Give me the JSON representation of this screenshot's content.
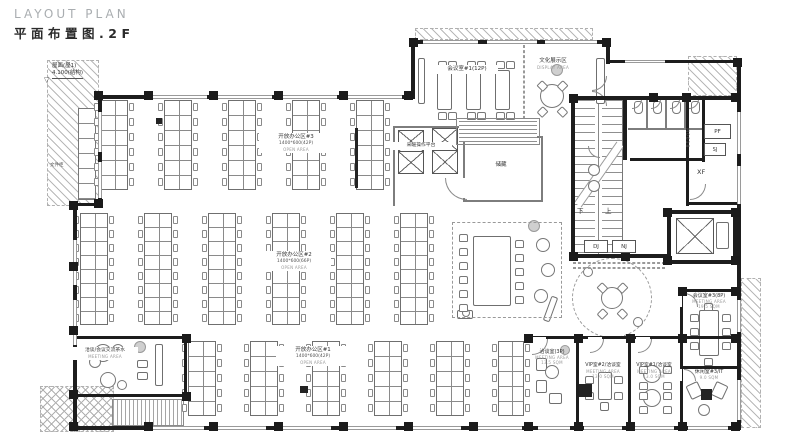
{
  "title": {
    "en": "LAYOUT PLAN",
    "zh": "平面布置图.2F"
  },
  "colors": {
    "wall": "#1d1d1d",
    "line": "#6f6f6f",
    "hatch": "#b8b8b8",
    "title_gray": "#a9adb0",
    "text": "#333333"
  },
  "annotations": {
    "roof_line1": "屋面(屋1)",
    "roof_line2": "4.100(结构)",
    "level_symbol": "▽",
    "cabinet": "文件柜",
    "platform": "采暖操作平台",
    "storage": "储藏",
    "stair_up": "上",
    "stair_down": "下",
    "dj": "DJ",
    "nj": "NJ",
    "pf": "PF",
    "sj": "SJ",
    "xf": "XF",
    "door_tag": "M0618"
  },
  "rooms": {
    "open3": {
      "name": "开放办公区#3",
      "spec": "1400*600(42P)",
      "en": "OPEN AREA"
    },
    "open2": {
      "name": "开放办公区#2",
      "spec": "1400*600(66P)",
      "en": "OPEN AREA"
    },
    "open1": {
      "name": "开放办公区#1",
      "spec": "1400*600(42P)",
      "en": "OPEN AREA"
    },
    "meeting1": {
      "name": "会议室#1(12P)"
    },
    "culture": {
      "name": "文化展示区",
      "en": "DISPLAY AREA"
    },
    "meeting3": {
      "name": "会议室#3(8P)",
      "en": "MEETING AREA",
      "area": "19.5 SQM"
    },
    "lounge3": {
      "name": "休闲室#3/IT",
      "area": "9.0 SQM"
    },
    "talk": {
      "name": "洽谈室(3P)",
      "en": "MEETING AREA",
      "area": "13.5 SQM"
    },
    "vip2": {
      "name": "VIP室#2/洽谈室",
      "en": "MEETING AREA",
      "area": "13.0 SQM"
    },
    "vip1": {
      "name": "VIP室#1/洽谈室",
      "en": "MEETING AREA",
      "area": "13.0 SQM"
    },
    "tea": {
      "name": "洽谈/会议交流茶水",
      "en": "MEETING AREA"
    }
  },
  "plan": {
    "hatches": [
      [
        47,
        60,
        52,
        146,
        "d"
      ],
      [
        40,
        386,
        74,
        46,
        "c"
      ],
      [
        688,
        56,
        49,
        40,
        "d"
      ],
      [
        741,
        278,
        20,
        150,
        "d"
      ],
      [
        415,
        28,
        178,
        12,
        "d"
      ]
    ],
    "deck": [
      112,
      399,
      72,
      27
    ],
    "cabinet_runs": [
      [
        78,
        108,
        18,
        92,
        15
      ]
    ],
    "desk_strips": [
      [
        100,
        100,
        6,
        15,
        28
      ],
      [
        164,
        100,
        6,
        15,
        28
      ],
      [
        228,
        100,
        6,
        15,
        28
      ],
      [
        292,
        100,
        6,
        15,
        28
      ],
      [
        356,
        100,
        6,
        15,
        28
      ],
      [
        80,
        213,
        8,
        14,
        28
      ],
      [
        144,
        213,
        8,
        14,
        28
      ],
      [
        208,
        213,
        8,
        14,
        28
      ],
      [
        272,
        213,
        8,
        14,
        28
      ],
      [
        336,
        213,
        8,
        14,
        28
      ],
      [
        400,
        213,
        8,
        14,
        28
      ],
      [
        188,
        341,
        5,
        15,
        28
      ],
      [
        250,
        341,
        5,
        15,
        28
      ],
      [
        312,
        341,
        5,
        15,
        28
      ],
      [
        374,
        341,
        5,
        15,
        28
      ],
      [
        436,
        341,
        5,
        15,
        28
      ],
      [
        498,
        341,
        5,
        15,
        26
      ]
    ],
    "tables": [
      [
        437,
        70,
        15,
        40
      ],
      [
        466,
        70,
        15,
        40
      ],
      [
        495,
        70,
        15,
        40
      ],
      [
        473,
        236,
        38,
        70
      ],
      [
        699,
        310,
        20,
        46
      ],
      [
        598,
        372,
        14,
        28
      ],
      [
        418,
        58,
        7,
        46
      ],
      [
        596,
        58,
        9,
        46
      ],
      [
        457,
        310,
        16,
        9
      ],
      [
        155,
        344,
        8,
        42
      ],
      [
        137,
        360,
        11,
        8
      ],
      [
        137,
        372,
        11,
        8
      ],
      [
        536,
        358,
        11,
        13
      ],
      [
        536,
        380,
        11,
        13
      ],
      [
        549,
        393,
        13,
        11
      ],
      [
        688,
        383,
        13,
        15,
        -25
      ],
      [
        713,
        383,
        13,
        15,
        25
      ],
      [
        600,
        402,
        9,
        9
      ],
      [
        716,
        222,
        13,
        27
      ],
      [
        547,
        296,
        7,
        26,
        20
      ]
    ],
    "toilets": [
      [
        634,
        101,
        9,
        13
      ],
      [
        653,
        101,
        9,
        13
      ],
      [
        672,
        101,
        9,
        13
      ],
      [
        691,
        101,
        9,
        13
      ]
    ],
    "filled": [
      [
        578,
        384,
        14,
        13
      ],
      [
        701,
        389,
        11,
        11
      ],
      [
        156,
        118,
        6,
        6
      ],
      [
        298,
        252,
        8,
        7
      ],
      [
        300,
        386,
        8,
        7
      ],
      [
        355,
        128,
        3,
        60
      ]
    ],
    "circles": [
      [
        612,
        298,
        40,
        "dash"
      ],
      [
        612,
        298,
        11,
        "s"
      ],
      [
        588,
        272,
        5,
        "s"
      ],
      [
        638,
        322,
        5,
        "s"
      ],
      [
        552,
        96,
        12,
        "s"
      ],
      [
        557,
        70,
        6,
        "g"
      ],
      [
        543,
        245,
        7,
        "s"
      ],
      [
        548,
        270,
        7,
        "s"
      ],
      [
        541,
        296,
        7,
        "s"
      ],
      [
        534,
        226,
        6,
        "g"
      ],
      [
        652,
        374,
        9,
        "s"
      ],
      [
        652,
        398,
        9,
        "s"
      ],
      [
        552,
        372,
        7,
        "s"
      ],
      [
        565,
        350,
        5,
        "g"
      ],
      [
        103,
        353,
        9,
        "s"
      ],
      [
        95,
        362,
        6,
        "s"
      ],
      [
        118,
        350,
        6,
        "s"
      ],
      [
        140,
        347,
        6,
        "g"
      ],
      [
        108,
        380,
        8,
        "s"
      ],
      [
        122,
        385,
        5,
        "s"
      ],
      [
        594,
        170,
        6,
        "s"
      ],
      [
        594,
        186,
        6,
        "s"
      ],
      [
        704,
        410,
        6,
        "s"
      ],
      [
        466,
        313,
        4,
        "s"
      ]
    ],
    "chairs": [
      [
        438,
        61
      ],
      [
        448,
        61
      ],
      [
        467,
        61
      ],
      [
        477,
        61
      ],
      [
        496,
        61
      ],
      [
        506,
        61
      ],
      [
        438,
        112
      ],
      [
        448,
        112
      ],
      [
        467,
        112
      ],
      [
        477,
        112
      ],
      [
        496,
        112
      ],
      [
        506,
        112
      ],
      [
        690,
        314
      ],
      [
        690,
        328
      ],
      [
        690,
        342
      ],
      [
        722,
        314
      ],
      [
        722,
        328
      ],
      [
        722,
        342
      ],
      [
        704,
        303
      ],
      [
        704,
        358
      ],
      [
        459,
        234
      ],
      [
        459,
        248
      ],
      [
        459,
        262
      ],
      [
        459,
        276
      ],
      [
        459,
        290
      ],
      [
        459,
        304
      ],
      [
        515,
        240
      ],
      [
        515,
        254
      ],
      [
        515,
        268
      ],
      [
        515,
        282
      ],
      [
        515,
        296
      ],
      [
        639,
        366
      ],
      [
        663,
        366
      ],
      [
        639,
        382
      ],
      [
        663,
        382
      ],
      [
        639,
        392
      ],
      [
        663,
        392
      ],
      [
        639,
        406
      ],
      [
        663,
        406
      ],
      [
        585,
        376
      ],
      [
        614,
        376
      ],
      [
        585,
        392
      ],
      [
        614,
        392
      ],
      [
        598,
        284,
        45
      ],
      [
        618,
        284,
        -45
      ],
      [
        598,
        310,
        -45
      ],
      [
        618,
        310,
        45
      ],
      [
        538,
        82,
        45
      ],
      [
        558,
        82,
        -45
      ],
      [
        538,
        108,
        -45
      ],
      [
        558,
        108,
        45
      ]
    ],
    "doors": [
      [
        532,
        339,
        16,
        "br"
      ],
      [
        590,
        339,
        14,
        "br"
      ],
      [
        638,
        339,
        14,
        "br"
      ],
      [
        684,
        293,
        14,
        "tr"
      ],
      [
        684,
        369,
        12,
        "tr"
      ],
      [
        445,
        178,
        22,
        "bl"
      ],
      [
        592,
        76,
        15,
        "br"
      ],
      [
        592,
        91,
        15,
        "tr"
      ],
      [
        632,
        99,
        10,
        "br"
      ],
      [
        651,
        99,
        10,
        "br"
      ],
      [
        670,
        99,
        10,
        "br"
      ],
      [
        689,
        99,
        10,
        "br"
      ],
      [
        588,
        146,
        12,
        "bl"
      ],
      [
        690,
        184,
        16,
        "br"
      ]
    ],
    "xboxes": [
      [
        398,
        130,
        26,
        44,
        2
      ],
      [
        432,
        128,
        26,
        46,
        2
      ],
      [
        676,
        218,
        38,
        36,
        1
      ]
    ],
    "thin_walls": [
      [
        463,
        136,
        80,
        2
      ],
      [
        463,
        136,
        2,
        66
      ],
      [
        463,
        200,
        80,
        2
      ],
      [
        541,
        136,
        2,
        66
      ],
      [
        393,
        126,
        2,
        80
      ],
      [
        393,
        126,
        70,
        2
      ],
      [
        646,
        100,
        2,
        30
      ],
      [
        665,
        100,
        2,
        30
      ],
      [
        684,
        100,
        2,
        30
      ],
      [
        628,
        128,
        78,
        2
      ]
    ],
    "walls": [
      [
        413,
        40,
        197,
        4
      ],
      [
        411,
        40,
        4,
        58
      ],
      [
        606,
        40,
        4,
        24
      ],
      [
        606,
        60,
        134,
        3
      ],
      [
        737,
        60,
        4,
        370
      ],
      [
        98,
        95,
        317,
        4
      ],
      [
        98,
        95,
        4,
        111
      ],
      [
        73,
        203,
        29,
        3
      ],
      [
        73,
        203,
        4,
        227
      ],
      [
        73,
        426,
        668,
        4
      ],
      [
        73,
        336,
        113,
        3
      ],
      [
        184,
        336,
        3,
        62
      ],
      [
        73,
        394,
        113,
        3
      ],
      [
        528,
        336,
        212,
        3
      ],
      [
        576,
        336,
        3,
        92
      ],
      [
        628,
        336,
        3,
        92
      ],
      [
        680,
        289,
        3,
        139
      ],
      [
        680,
        289,
        60,
        3
      ],
      [
        680,
        366,
        58,
        3
      ],
      [
        571,
        96,
        169,
        4
      ],
      [
        571,
        96,
        4,
        162
      ],
      [
        623,
        96,
        4,
        64
      ],
      [
        571,
        254,
        96,
        4
      ],
      [
        702,
        96,
        3,
        66
      ],
      [
        686,
        96,
        3,
        110
      ],
      [
        630,
        158,
        74,
        3
      ],
      [
        686,
        202,
        51,
        3
      ],
      [
        667,
        210,
        72,
        4
      ],
      [
        667,
        210,
        4,
        54
      ],
      [
        667,
        260,
        72,
        4
      ],
      [
        733,
        210,
        4,
        54
      ]
    ],
    "windows": [
      [
        152,
        95,
        55,
        4
      ],
      [
        217,
        95,
        55,
        4
      ],
      [
        282,
        95,
        55,
        4
      ],
      [
        347,
        95,
        55,
        4
      ],
      [
        423,
        40,
        55,
        4
      ],
      [
        487,
        40,
        50,
        4
      ],
      [
        545,
        40,
        52,
        4
      ],
      [
        625,
        60,
        40,
        3
      ],
      [
        98,
        112,
        4,
        40
      ],
      [
        98,
        162,
        4,
        36
      ],
      [
        73,
        240,
        4,
        45
      ],
      [
        73,
        300,
        4,
        45
      ],
      [
        152,
        426,
        52,
        4
      ],
      [
        214,
        426,
        52,
        4
      ],
      [
        279,
        426,
        52,
        4
      ],
      [
        344,
        426,
        52,
        4
      ],
      [
        409,
        426,
        52,
        4
      ],
      [
        474,
        426,
        48,
        4
      ],
      [
        538,
        426,
        32,
        4
      ],
      [
        584,
        426,
        38,
        4
      ],
      [
        634,
        426,
        40,
        4
      ],
      [
        688,
        426,
        40,
        4
      ],
      [
        737,
        112,
        4,
        42
      ],
      [
        737,
        166,
        4,
        38
      ],
      [
        737,
        300,
        4,
        32
      ],
      [
        737,
        380,
        4,
        40
      ]
    ],
    "gaps": [
      [
        530,
        337,
        16,
        2
      ],
      [
        588,
        337,
        14,
        2
      ],
      [
        636,
        337,
        14,
        2
      ],
      [
        680,
        293,
        2,
        14
      ],
      [
        680,
        369,
        2,
        12
      ],
      [
        463,
        178,
        2,
        20
      ]
    ],
    "columns": [
      [
        94,
        91
      ],
      [
        144,
        91
      ],
      [
        209,
        91
      ],
      [
        274,
        91
      ],
      [
        339,
        91
      ],
      [
        404,
        91
      ],
      [
        409,
        38
      ],
      [
        602,
        38
      ],
      [
        649,
        93
      ],
      [
        682,
        93
      ],
      [
        731,
        93
      ],
      [
        733,
        58
      ],
      [
        94,
        199
      ],
      [
        69,
        201
      ],
      [
        69,
        262
      ],
      [
        69,
        326
      ],
      [
        69,
        390
      ],
      [
        69,
        422
      ],
      [
        144,
        422
      ],
      [
        209,
        422
      ],
      [
        274,
        422
      ],
      [
        339,
        422
      ],
      [
        404,
        422
      ],
      [
        469,
        422
      ],
      [
        524,
        422
      ],
      [
        574,
        422
      ],
      [
        626,
        422
      ],
      [
        678,
        422
      ],
      [
        731,
        422
      ],
      [
        524,
        334
      ],
      [
        574,
        334
      ],
      [
        626,
        334
      ],
      [
        678,
        334
      ],
      [
        731,
        334
      ],
      [
        678,
        287
      ],
      [
        731,
        287
      ],
      [
        569,
        94
      ],
      [
        569,
        252
      ],
      [
        621,
        252
      ],
      [
        663,
        208
      ],
      [
        731,
        208
      ],
      [
        663,
        256
      ],
      [
        731,
        256
      ],
      [
        182,
        334
      ],
      [
        182,
        392
      ]
    ],
    "dashed": [
      [
        452,
        222,
        110,
        96
      ],
      [
        573,
        262,
        92,
        1
      ],
      [
        573,
        267,
        92,
        1
      ],
      [
        523,
        45,
        1,
        84
      ]
    ]
  }
}
